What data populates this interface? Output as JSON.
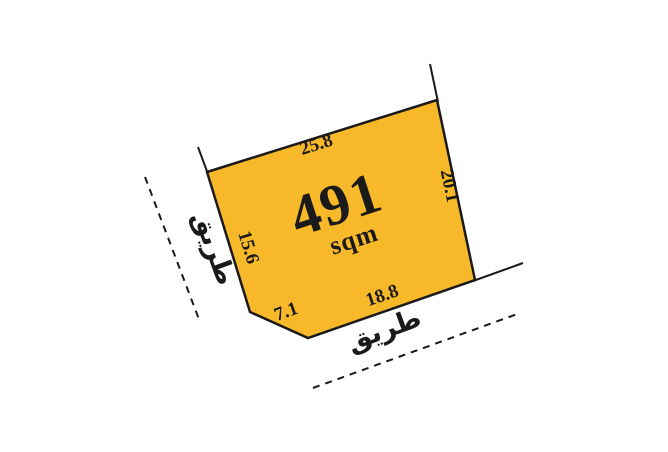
{
  "diagram": {
    "area": {
      "value": "491",
      "unit": "sqm"
    },
    "dimensions": {
      "top": "25.8",
      "right": "20.1",
      "bottom": "18.8",
      "bottom_left": "7.1",
      "left": "15.6"
    },
    "roads": {
      "left_label": "طريق",
      "bottom_label": "طريق"
    }
  },
  "colors": {
    "plot_fill": "#F7B82A",
    "line_color": "#1A1A1A",
    "text_color": "#1A1A1A",
    "background": "#FFFFFF"
  }
}
